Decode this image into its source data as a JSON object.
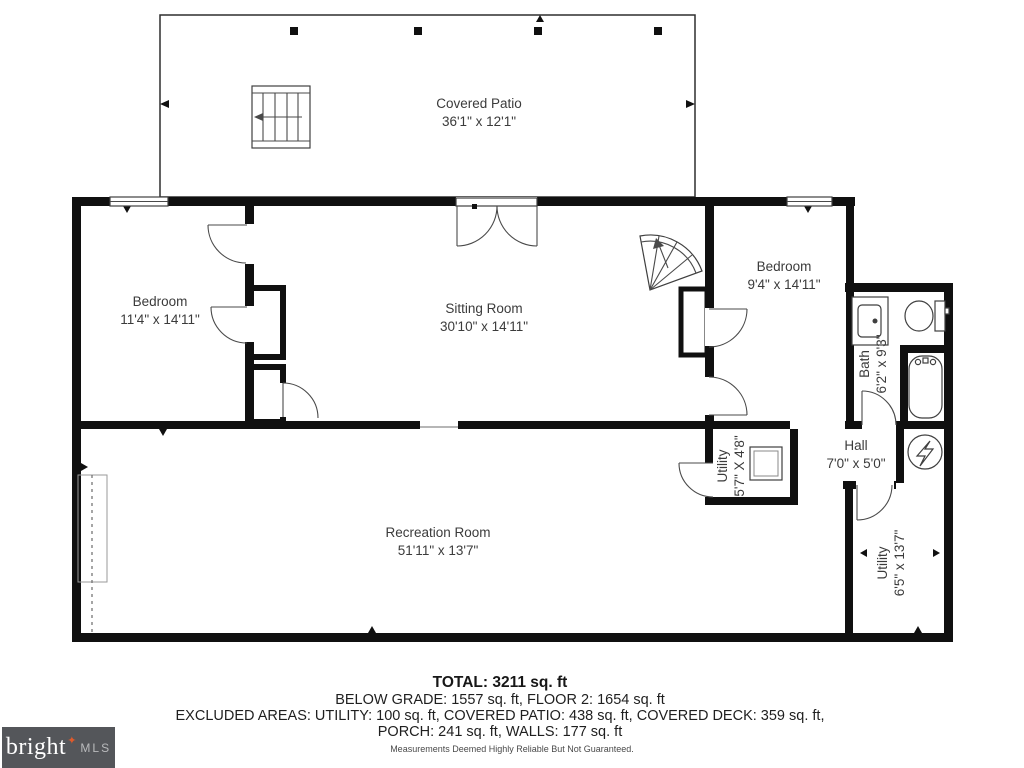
{
  "rooms": {
    "covered_patio": {
      "name": "Covered Patio",
      "dims": "36'1\" x 12'1\""
    },
    "bedroom_left": {
      "name": "Bedroom",
      "dims": "11'4\" x 14'11\""
    },
    "sitting_room": {
      "name": "Sitting Room",
      "dims": "30'10\" x 14'11\""
    },
    "bedroom_right": {
      "name": "Bedroom",
      "dims": "9'4\" x 14'11\""
    },
    "bath": {
      "name": "Bath",
      "dims": "6'2\" x 9'3\""
    },
    "utility_small": {
      "name": "Utility",
      "dims": "5'7\" X 4'8\""
    },
    "hall": {
      "name": "Hall",
      "dims": "7'0\" x 5'0\""
    },
    "utility_large": {
      "name": "Utility",
      "dims": "6'5\" x 13'7\""
    },
    "recreation": {
      "name": "Recreation Room",
      "dims": "51'11\" x 13'7\""
    }
  },
  "summary": {
    "total": "TOTAL: 3211 sq. ft",
    "line2": "BELOW GRADE: 1557 sq. ft, FLOOR 2: 1654 sq. ft",
    "line3": "EXCLUDED AREAS: UTILITY: 100 sq. ft, COVERED PATIO: 438 sq. ft, COVERED DECK: 359 sq. ft,",
    "line4": "PORCH: 241 sq. ft, WALLS: 177 sq. ft",
    "disclaimer": "Measurements Deemed Highly Reliable But Not Guaranteed."
  },
  "logo": {
    "brand": "bright",
    "star": "✦",
    "suffix": "MLS"
  },
  "colors": {
    "wall": "#101010",
    "logo_bg": "#54565a",
    "logo_star": "#e05a2b"
  }
}
